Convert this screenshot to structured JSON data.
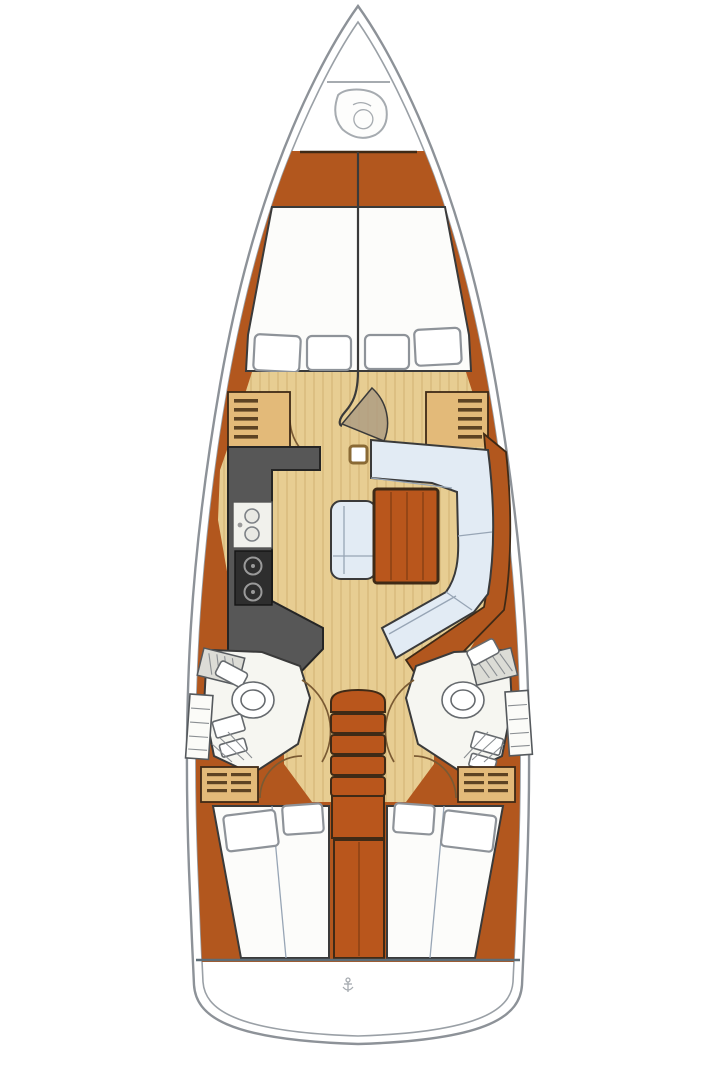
{
  "diagram": {
    "label": "Sailing yacht interior layout floor plan, top view, bow up",
    "regions": [
      {
        "id": "bow-anchor-locker",
        "kind": "locker"
      },
      {
        "id": "windlass-fitting",
        "kind": "deck-hardware"
      },
      {
        "id": "forward-cabin-v-berth",
        "kind": "double-berth",
        "pillows": 4
      },
      {
        "id": "forward-cabin-shelf-port",
        "kind": "shelf-unit"
      },
      {
        "id": "forward-cabin-shelf-starboard",
        "kind": "shelf-unit"
      },
      {
        "id": "forward-cabin-door",
        "kind": "door-swing"
      },
      {
        "id": "galley-port",
        "kind": "galley",
        "features": [
          "double-sink",
          "two-burner-stove",
          "l-shaped-counter"
        ]
      },
      {
        "id": "mast-post",
        "kind": "structure"
      },
      {
        "id": "salon-dinette",
        "kind": "u-shaped-settee-with-table"
      },
      {
        "id": "salon-bench-seat",
        "kind": "seat"
      },
      {
        "id": "head-port",
        "kind": "bathroom",
        "features": [
          "toilet",
          "vanity",
          "shower"
        ]
      },
      {
        "id": "head-starboard",
        "kind": "bathroom",
        "features": [
          "toilet",
          "vanity",
          "shower"
        ]
      },
      {
        "id": "companionway-steps",
        "kind": "ladder",
        "steps": 5
      },
      {
        "id": "hanging-locker-port",
        "kind": "locker"
      },
      {
        "id": "hanging-locker-starboard",
        "kind": "locker"
      },
      {
        "id": "aft-cabin-port",
        "kind": "double-berth",
        "pillows": 2
      },
      {
        "id": "aft-cabin-starboard",
        "kind": "double-berth",
        "pillows": 2
      },
      {
        "id": "engine-compartment",
        "kind": "structure"
      },
      {
        "id": "transom",
        "kind": "deck"
      }
    ]
  },
  "palette": {
    "hullStroke": "#8d9298",
    "innerStroke": "#9aa0a6",
    "wood": "#b2571e",
    "woodBright": "#b9561c",
    "woodDark": "#3f2a16",
    "woodLine": "#8a4114",
    "floor": "#e7cd92",
    "floorLine": "#d4b678",
    "roomWhite": "#f6f6f1",
    "berthWhite": "#fcfcfa",
    "settee": "#e2ebf4",
    "setteeSeam": "#97a5b5",
    "locker": "#e3ba79",
    "lockerStripe": "#5d4323",
    "galley": "#575757",
    "stoveDark": "#2e2e2e",
    "metal": "#9a9a9a",
    "outline": "#3a3a3a",
    "pillowStroke": "#8e9399",
    "arc": "#7a5a33",
    "sternLine": "#5d6d77",
    "glyph": "#a6abb0"
  }
}
